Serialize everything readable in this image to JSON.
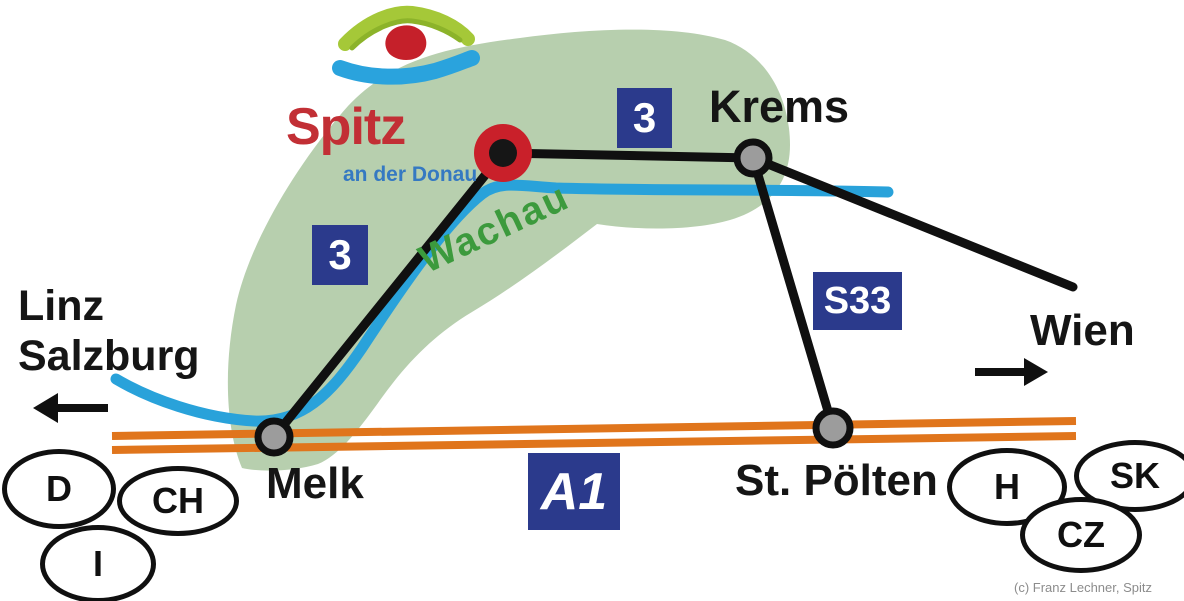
{
  "logo": {
    "title": "Spitz",
    "subtitle": "an der Donau"
  },
  "region": {
    "label": "Wachau"
  },
  "labels": {
    "krems": "Krems",
    "melk": "Melk",
    "st_poelten": "St. Pölten",
    "wien": "Wien",
    "linz": "Linz",
    "salzburg": "Salzburg"
  },
  "road_signs": {
    "b3_upper": "3",
    "b3_lower": "3",
    "s33": "S33",
    "a1": "A1"
  },
  "country_badges": {
    "d": "D",
    "ch": "CH",
    "i": "I",
    "h": "H",
    "sk": "SK",
    "cz": "CZ"
  },
  "credit": "(c) Franz Lechner, Spitz",
  "colors": {
    "region_green": "#b7cfae",
    "river_blue": "#29a2da",
    "highway_orange": "#e0751c",
    "road_black": "#101010",
    "sign_navy": "#2b3a8c",
    "region_label_green": "#3c9a3d",
    "logo_red": "#c22f35",
    "logo_subtitle_blue": "#3579c2",
    "marker_red": "#c9202a",
    "node_gray": "#9c9c9c"
  }
}
